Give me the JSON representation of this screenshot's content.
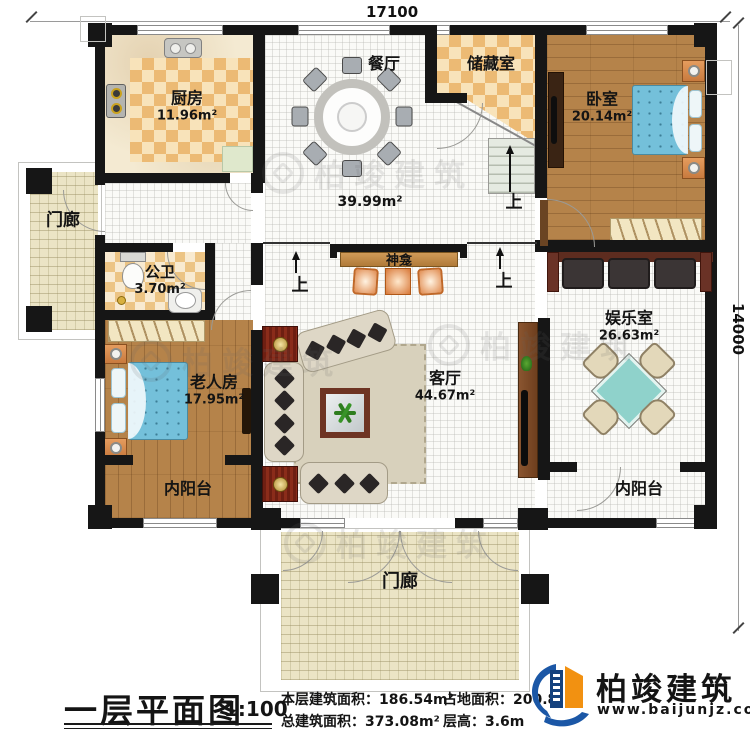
{
  "dimensions": {
    "top": "17100",
    "right": "14000"
  },
  "rooms": {
    "kitchen": {
      "name": "厨房",
      "area": "11.96m²"
    },
    "dining": {
      "name": "餐厅"
    },
    "storage": {
      "name": "储藏室"
    },
    "bedroom": {
      "name": "卧室",
      "area": "20.14m²"
    },
    "hall": {
      "area": "39.99m²"
    },
    "shrine": {
      "name": "神龛"
    },
    "bathroom": {
      "name": "公卫",
      "area": "3.70m²"
    },
    "elder_room": {
      "name": "老人房",
      "area": "17.95m²"
    },
    "living_room": {
      "name": "客厅",
      "area": "44.67m²"
    },
    "entertainment": {
      "name": "娱乐室",
      "area": "26.63m²"
    },
    "balcony_left": {
      "name": "内阳台"
    },
    "balcony_right": {
      "name": "内阳台"
    },
    "porch_left": {
      "name": "门廊"
    },
    "porch_bottom": {
      "name": "门廊"
    }
  },
  "labels": {
    "up": "上"
  },
  "watermark": {
    "text": "柏竣建筑"
  },
  "footer": {
    "title": "一层平面图",
    "scale": "1:100",
    "stats": {
      "floor_area_label": "本层建筑面积：",
      "floor_area_value": "186.54m²",
      "land_area_label": "占地面积：",
      "land_area_value": "200.8",
      "total_area_label": "总建筑面积：",
      "total_area_value": "373.08m²",
      "height_label": "层高：",
      "height_value": "3.6m"
    },
    "brand": {
      "name": "柏竣建筑",
      "website": "www.baijunjz.com"
    }
  },
  "colors": {
    "wall": "#161616",
    "wood_floor": "#b5834a",
    "checker": "#ecba74",
    "bed_blue": "#74c0da",
    "mahjong_teal": "#8fd2cb",
    "brand_blue": "#1b57a6",
    "brand_orange": "#f29111"
  }
}
